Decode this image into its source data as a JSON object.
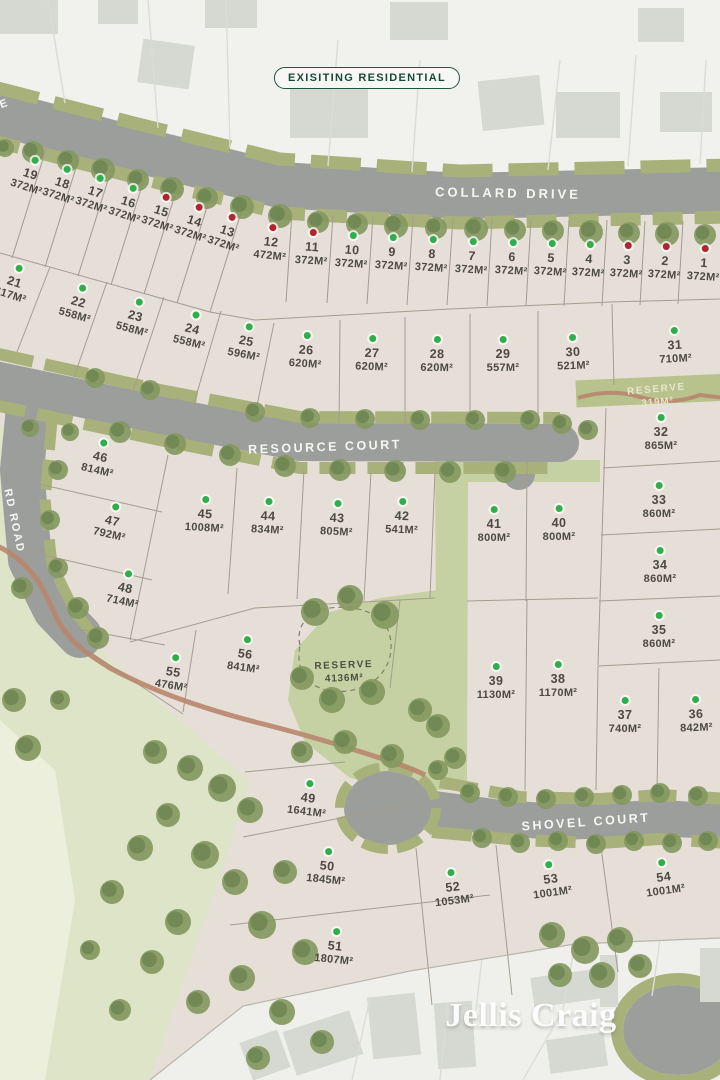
{
  "map": {
    "badge": "EXISITING RESIDENTIAL",
    "logo": "Jellis Craig"
  },
  "legend_colors": {
    "available": "#2fae49",
    "sold": "#b2252c"
  },
  "streets": [
    {
      "name": "COLLARD DRIVE",
      "x": 508,
      "y": 193,
      "rot": 1,
      "size": 13,
      "spacing": 3
    },
    {
      "name": "RESOURCE COURT",
      "x": 325,
      "y": 447,
      "rot": -2,
      "size": 12.5,
      "spacing": 2.5
    },
    {
      "name": "SHOVEL COURT",
      "x": 586,
      "y": 822,
      "rot": -4,
      "size": 12.5,
      "spacing": 2.5
    },
    {
      "name": "RD ROAD",
      "x": 14,
      "y": 521,
      "rot": 78,
      "size": 11,
      "spacing": 2
    },
    {
      "name": "E",
      "x": 4,
      "y": 104,
      "rot": -20,
      "size": 11,
      "spacing": 1
    }
  ],
  "reserves": [
    {
      "name": "RESERVE",
      "area": "319M²",
      "x": 657,
      "y": 396,
      "rot": -5,
      "style": "light"
    },
    {
      "name": "RESERVE",
      "area": "4136M²",
      "x": 344,
      "y": 672,
      "rot": -2,
      "style": "dark"
    }
  ],
  "lots": [
    {
      "num": "1",
      "area": "372M²",
      "status": "sold",
      "x": 704,
      "y": 252,
      "rot": 4
    },
    {
      "num": "2",
      "area": "372M²",
      "status": "sold",
      "x": 665,
      "y": 250,
      "rot": 4
    },
    {
      "num": "3",
      "area": "372M²",
      "status": "sold",
      "x": 627,
      "y": 249,
      "rot": 4
    },
    {
      "num": "4",
      "area": "372M²",
      "status": "available",
      "x": 589,
      "y": 248,
      "rot": 4
    },
    {
      "num": "5",
      "area": "372M²",
      "status": "available",
      "x": 551,
      "y": 247,
      "rot": 4
    },
    {
      "num": "6",
      "area": "372M²",
      "status": "available",
      "x": 512,
      "y": 246,
      "rot": 4
    },
    {
      "num": "7",
      "area": "372M²",
      "status": "available",
      "x": 472,
      "y": 245,
      "rot": 4
    },
    {
      "num": "8",
      "area": "372M²",
      "status": "available",
      "x": 432,
      "y": 243,
      "rot": 4
    },
    {
      "num": "9",
      "area": "372M²",
      "status": "available",
      "x": 392,
      "y": 241,
      "rot": 4
    },
    {
      "num": "10",
      "area": "372M²",
      "status": "available",
      "x": 352,
      "y": 239,
      "rot": 4
    },
    {
      "num": "11",
      "area": "372M²",
      "status": "sold",
      "x": 312,
      "y": 236,
      "rot": 4
    },
    {
      "num": "12",
      "area": "472M²",
      "status": "sold",
      "x": 271,
      "y": 231,
      "rot": 6
    },
    {
      "num": "13",
      "area": "372M²",
      "status": "sold",
      "x": 227,
      "y": 220,
      "rot": 18
    },
    {
      "num": "14",
      "area": "372M²",
      "status": "sold",
      "x": 194,
      "y": 210,
      "rot": 18
    },
    {
      "num": "15",
      "area": "372M²",
      "status": "sold",
      "x": 161,
      "y": 200,
      "rot": 18
    },
    {
      "num": "16",
      "area": "372M²",
      "status": "available",
      "x": 128,
      "y": 191,
      "rot": 18
    },
    {
      "num": "17",
      "area": "372M²",
      "status": "available",
      "x": 95,
      "y": 181,
      "rot": 18
    },
    {
      "num": "18",
      "area": "372M²",
      "status": "available",
      "x": 62,
      "y": 172,
      "rot": 18
    },
    {
      "num": "19",
      "area": "372M²",
      "status": "available",
      "x": 30,
      "y": 163,
      "rot": 18
    },
    {
      "num": "21",
      "area": "617M²",
      "status": "available",
      "x": 14,
      "y": 271,
      "rot": 18
    },
    {
      "num": "22",
      "area": "558M²",
      "status": "available",
      "x": 78,
      "y": 291,
      "rot": 16
    },
    {
      "num": "23",
      "area": "558M²",
      "status": "available",
      "x": 135,
      "y": 305,
      "rot": 15
    },
    {
      "num": "24",
      "area": "558M²",
      "status": "available",
      "x": 192,
      "y": 318,
      "rot": 14
    },
    {
      "num": "25",
      "area": "596M²",
      "status": "available",
      "x": 246,
      "y": 330,
      "rot": 11
    },
    {
      "num": "26",
      "area": "620M²",
      "status": "available",
      "x": 306,
      "y": 339,
      "rot": 4
    },
    {
      "num": "27",
      "area": "620M²",
      "status": "available",
      "x": 372,
      "y": 342,
      "rot": 2
    },
    {
      "num": "28",
      "area": "620M²",
      "status": "available",
      "x": 437,
      "y": 343,
      "rot": 1
    },
    {
      "num": "29",
      "area": "557M²",
      "status": "available",
      "x": 503,
      "y": 343,
      "rot": 0
    },
    {
      "num": "30",
      "area": "521M²",
      "status": "available",
      "x": 573,
      "y": 341,
      "rot": -2
    },
    {
      "num": "31",
      "area": "710M²",
      "status": "available",
      "x": 675,
      "y": 334,
      "rot": -3
    },
    {
      "num": "32",
      "area": "865M²",
      "status": "available",
      "x": 661,
      "y": 421,
      "rot": 0
    },
    {
      "num": "33",
      "area": "860M²",
      "status": "available",
      "x": 659,
      "y": 489,
      "rot": 0
    },
    {
      "num": "34",
      "area": "860M²",
      "status": "available",
      "x": 660,
      "y": 554,
      "rot": 0
    },
    {
      "num": "35",
      "area": "860M²",
      "status": "available",
      "x": 659,
      "y": 619,
      "rot": 0
    },
    {
      "num": "36",
      "area": "842M²",
      "status": "available",
      "x": 696,
      "y": 703,
      "rot": -2
    },
    {
      "num": "37",
      "area": "740M²",
      "status": "available",
      "x": 625,
      "y": 704,
      "rot": 0
    },
    {
      "num": "38",
      "area": "1170M²",
      "status": "available",
      "x": 558,
      "y": 668,
      "rot": 0
    },
    {
      "num": "39",
      "area": "1130M²",
      "status": "available",
      "x": 496,
      "y": 670,
      "rot": 0
    },
    {
      "num": "40",
      "area": "800M²",
      "status": "available",
      "x": 559,
      "y": 512,
      "rot": 0
    },
    {
      "num": "41",
      "area": "800M²",
      "status": "available",
      "x": 494,
      "y": 513,
      "rot": 0
    },
    {
      "num": "42",
      "area": "541M²",
      "status": "available",
      "x": 402,
      "y": 505,
      "rot": 2
    },
    {
      "num": "43",
      "area": "805M²",
      "status": "available",
      "x": 337,
      "y": 507,
      "rot": 3
    },
    {
      "num": "44",
      "area": "834M²",
      "status": "available",
      "x": 268,
      "y": 505,
      "rot": 3
    },
    {
      "num": "45",
      "area": "1008M²",
      "status": "available",
      "x": 205,
      "y": 503,
      "rot": 3
    },
    {
      "num": "46",
      "area": "814M²",
      "status": "available",
      "x": 100,
      "y": 446,
      "rot": 13
    },
    {
      "num": "47",
      "area": "792M²",
      "status": "available",
      "x": 112,
      "y": 510,
      "rot": 13
    },
    {
      "num": "48",
      "area": "714M²",
      "status": "available",
      "x": 125,
      "y": 577,
      "rot": 12
    },
    {
      "num": "49",
      "area": "1641M²",
      "status": "available",
      "x": 308,
      "y": 787,
      "rot": 7
    },
    {
      "num": "50",
      "area": "1845M²",
      "status": "available",
      "x": 327,
      "y": 855,
      "rot": 6
    },
    {
      "num": "51",
      "area": "1807M²",
      "status": "available",
      "x": 335,
      "y": 935,
      "rot": 6
    },
    {
      "num": "52",
      "area": "1053M²",
      "status": "available",
      "x": 453,
      "y": 876,
      "rot": -7
    },
    {
      "num": "53",
      "area": "1001M²",
      "status": "available",
      "x": 551,
      "y": 868,
      "rot": -8
    },
    {
      "num": "54",
      "area": "1001M²",
      "status": "available",
      "x": 664,
      "y": 866,
      "rot": -8
    },
    {
      "num": "55",
      "area": "476M²",
      "status": "available",
      "x": 173,
      "y": 661,
      "rot": 9
    },
    {
      "num": "56",
      "area": "841M²",
      "status": "available",
      "x": 245,
      "y": 643,
      "rot": 8
    }
  ]
}
